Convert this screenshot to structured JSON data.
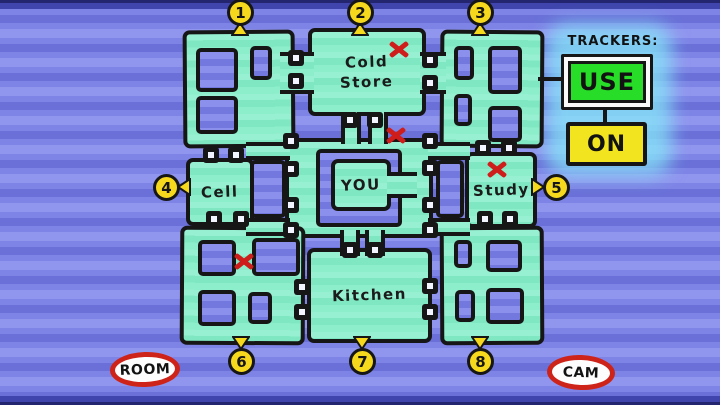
{
  "colors": {
    "background_blue": "#7B81E3",
    "map_teal": "#84EBC6",
    "hole_blue": "#7F85E6",
    "wall_black": "#161616",
    "pin_yellow": "#F6D81D",
    "x_mark_red": "#CE1D1A",
    "use_green": "#27DD27",
    "on_yellow": "#F2E41E",
    "oval_red": "#CE2318",
    "glow_cyan": "#86E8F8"
  },
  "trackers": {
    "title": "TRACKERS:",
    "use_button": "USE",
    "on_button": "ON"
  },
  "legend": {
    "room_label": "ROOM",
    "cam_label": "CAM"
  },
  "map": {
    "room_labels": [
      "Cold Store",
      "Cell",
      "YOU",
      "Study",
      "Kitchen"
    ],
    "pins": [
      {
        "n": "1",
        "x": 240,
        "y": 12,
        "dir": "up"
      },
      {
        "n": "2",
        "x": 360,
        "y": 12,
        "dir": "up"
      },
      {
        "n": "3",
        "x": 480,
        "y": 12,
        "dir": "up"
      },
      {
        "n": "4",
        "x": 166,
        "y": 187,
        "dir": "left"
      },
      {
        "n": "5",
        "x": 556,
        "y": 187,
        "dir": "right"
      },
      {
        "n": "6",
        "x": 241,
        "y": 361,
        "dir": "down"
      },
      {
        "n": "7",
        "x": 362,
        "y": 361,
        "dir": "down"
      },
      {
        "n": "8",
        "x": 480,
        "y": 361,
        "dir": "down"
      }
    ],
    "x_marks": [
      {
        "near": "cold-store",
        "x": 399,
        "y": 49
      },
      {
        "near": "center-corridor",
        "x": 396,
        "y": 135
      },
      {
        "near": "study",
        "x": 497,
        "y": 169
      },
      {
        "near": "bottom-left-room",
        "x": 244,
        "y": 261
      }
    ],
    "doors": [
      [
        296,
        58
      ],
      [
        296,
        81
      ],
      [
        430,
        60
      ],
      [
        430,
        83
      ],
      [
        350,
        120
      ],
      [
        375,
        120
      ],
      [
        291,
        141
      ],
      [
        430,
        141
      ],
      [
        291,
        169
      ],
      [
        291,
        205
      ],
      [
        430,
        168
      ],
      [
        430,
        205
      ],
      [
        291,
        230
      ],
      [
        430,
        230
      ],
      [
        211,
        155
      ],
      [
        236,
        155
      ],
      [
        214,
        219
      ],
      [
        241,
        219
      ],
      [
        483,
        148
      ],
      [
        509,
        148
      ],
      [
        485,
        219
      ],
      [
        510,
        219
      ],
      [
        350,
        250
      ],
      [
        375,
        250
      ],
      [
        302,
        287
      ],
      [
        302,
        312
      ],
      [
        430,
        286
      ],
      [
        430,
        312
      ]
    ],
    "pieces": [
      {
        "name": "corridor-slab",
        "cls": "blk",
        "x": 285,
        "y": 138,
        "w": 148,
        "h": 100
      },
      {
        "name": "block-top-left",
        "cls": "blk",
        "x": 183,
        "y": 30,
        "w": 112,
        "h": 118,
        "rot": -0.4
      },
      {
        "name": "block-top-right",
        "cls": "blk",
        "x": 440,
        "y": 30,
        "w": 104,
        "h": 118,
        "rot": 0.4
      },
      {
        "name": "block-bottom-left",
        "cls": "blk",
        "x": 180,
        "y": 226,
        "w": 125,
        "h": 119,
        "rot": 0.3
      },
      {
        "name": "block-bottom-right",
        "cls": "blk",
        "x": 440,
        "y": 226,
        "w": 104,
        "h": 119,
        "rot": -0.3
      },
      {
        "name": "room-cold-store",
        "cls": "blk",
        "x": 308,
        "y": 28,
        "w": 118,
        "h": 88,
        "label": "Cold\nStore"
      },
      {
        "name": "room-cell",
        "cls": "blk",
        "x": 186,
        "y": 158,
        "w": 68,
        "h": 68,
        "label": "Cell"
      },
      {
        "name": "room-study",
        "cls": "blk",
        "x": 465,
        "y": 152,
        "w": 72,
        "h": 76,
        "label": "Study"
      },
      {
        "name": "room-kitchen",
        "cls": "blk",
        "x": 307,
        "y": 248,
        "w": 125,
        "h": 95,
        "label": "Kitchen"
      },
      {
        "name": "corridor-topleft",
        "cls": "hcorr",
        "x": 280,
        "y": 52,
        "w": 34,
        "h": 42
      },
      {
        "name": "corridor-topright",
        "cls": "hcorr",
        "x": 420,
        "y": 52,
        "w": 26,
        "h": 42
      },
      {
        "name": "corridor-coldstore-a",
        "cls": "vcorr",
        "x": 341,
        "y": 112,
        "w": 20,
        "h": 32
      },
      {
        "name": "corridor-coldstore-b",
        "cls": "vcorr",
        "x": 368,
        "y": 112,
        "w": 20,
        "h": 32
      },
      {
        "name": "corridor-cell-top",
        "cls": "hcorr",
        "x": 246,
        "y": 142,
        "w": 44,
        "h": 18
      },
      {
        "name": "corridor-cell-bottom",
        "cls": "hcorr",
        "x": 246,
        "y": 218,
        "w": 44,
        "h": 18
      },
      {
        "name": "corridor-study-top",
        "cls": "hcorr",
        "x": 428,
        "y": 142,
        "w": 42,
        "h": 18
      },
      {
        "name": "corridor-study-bottom",
        "cls": "hcorr",
        "x": 428,
        "y": 218,
        "w": 42,
        "h": 18
      },
      {
        "name": "corridor-kitchen-a",
        "cls": "vcorr",
        "x": 340,
        "y": 230,
        "w": 20,
        "h": 26
      },
      {
        "name": "corridor-kitchen-b",
        "cls": "vcorr",
        "x": 365,
        "y": 230,
        "w": 20,
        "h": 26
      },
      {
        "name": "hole-tl-1",
        "cls": "hole",
        "x": 196,
        "y": 48,
        "w": 42,
        "h": 44
      },
      {
        "name": "hole-tl-2",
        "cls": "hole",
        "x": 250,
        "y": 46,
        "w": 22,
        "h": 34
      },
      {
        "name": "hole-tl-3",
        "cls": "hole",
        "x": 196,
        "y": 96,
        "w": 42,
        "h": 38
      },
      {
        "name": "hole-tr-1",
        "cls": "hole",
        "x": 454,
        "y": 46,
        "w": 20,
        "h": 34
      },
      {
        "name": "hole-tr-2",
        "cls": "hole",
        "x": 488,
        "y": 46,
        "w": 34,
        "h": 48
      },
      {
        "name": "hole-tr-3",
        "cls": "hole",
        "x": 454,
        "y": 94,
        "w": 18,
        "h": 32
      },
      {
        "name": "hole-tr-4",
        "cls": "hole",
        "x": 488,
        "y": 106,
        "w": 34,
        "h": 36
      },
      {
        "name": "hole-cell-gap",
        "cls": "hole",
        "x": 250,
        "y": 160,
        "w": 36,
        "h": 58
      },
      {
        "name": "hole-study-gap",
        "cls": "hole",
        "x": 436,
        "y": 160,
        "w": 28,
        "h": 58
      },
      {
        "name": "courtyard-hole",
        "cls": "hole",
        "x": 316,
        "y": 149,
        "w": 86,
        "h": 78
      },
      {
        "name": "room-you",
        "cls": "blk",
        "x": 331,
        "y": 159,
        "w": 60,
        "h": 52,
        "label": "YOU"
      },
      {
        "name": "you-bridge",
        "cls": "hcorr",
        "x": 387,
        "y": 172,
        "w": 30,
        "h": 26
      },
      {
        "name": "hole-bl-1",
        "cls": "hole",
        "x": 198,
        "y": 240,
        "w": 38,
        "h": 36
      },
      {
        "name": "hole-bl-2",
        "cls": "hole",
        "x": 252,
        "y": 238,
        "w": 48,
        "h": 38
      },
      {
        "name": "hole-bl-3",
        "cls": "hole",
        "x": 198,
        "y": 290,
        "w": 38,
        "h": 36
      },
      {
        "name": "hole-bl-4",
        "cls": "hole",
        "x": 248,
        "y": 292,
        "w": 24,
        "h": 32
      },
      {
        "name": "hole-br-1",
        "cls": "hole",
        "x": 454,
        "y": 240,
        "w": 18,
        "h": 28
      },
      {
        "name": "hole-br-2",
        "cls": "hole",
        "x": 486,
        "y": 240,
        "w": 36,
        "h": 32
      },
      {
        "name": "hole-br-3",
        "cls": "hole",
        "x": 455,
        "y": 290,
        "w": 20,
        "h": 32
      },
      {
        "name": "hole-br-4",
        "cls": "hole",
        "x": 486,
        "y": 288,
        "w": 38,
        "h": 36
      }
    ]
  }
}
